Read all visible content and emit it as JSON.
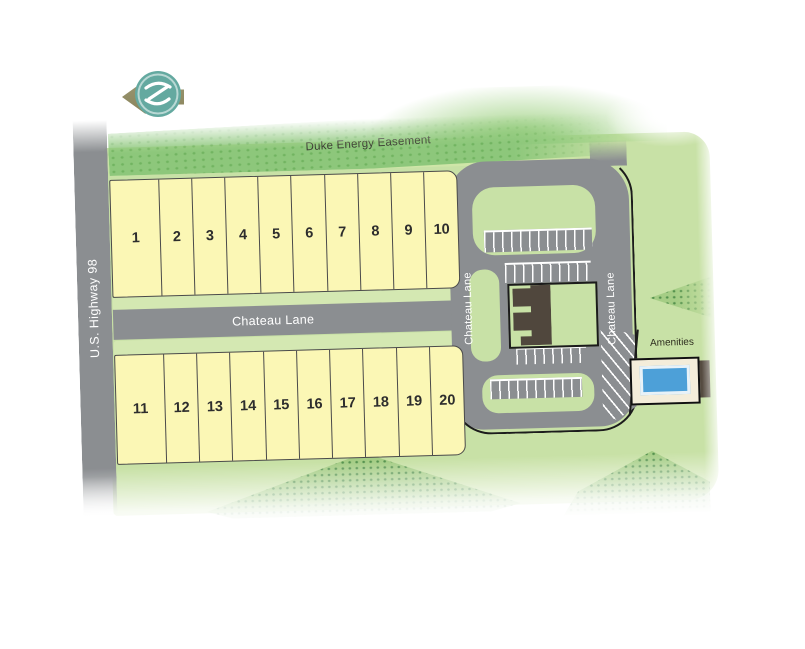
{
  "back_button": {
    "icon": "back-arrow-icon",
    "logo": "brand-globe-logo"
  },
  "labels": {
    "easement": "Duke Energy Easement",
    "highway": "U.S. Highway 98",
    "street": "Chateau Lane",
    "street_vertical_left": "Chateau Lane",
    "street_vertical_right": "Chateau Lane",
    "amenities": "Amenities"
  },
  "lots": {
    "row_top": [
      "1",
      "2",
      "3",
      "4",
      "5",
      "6",
      "7",
      "8",
      "9",
      "10"
    ],
    "row_bottom": [
      "11",
      "12",
      "13",
      "14",
      "15",
      "16",
      "17",
      "18",
      "19",
      "20"
    ]
  },
  "colors": {
    "lot_fill": "#FBF7B5",
    "lot_border": "#4A4A4A",
    "road_gray": "#8B8E91",
    "grass_green": "#C8E1A6",
    "verge_green": "#D4E8B2",
    "easement_green": "#8DC77B",
    "pool_blue": "#4DA0D8",
    "building_brown": "#50473D",
    "deck_cream": "#F4EDDA",
    "arrow_olive": "#8F8A60",
    "logo_teal": "#64A9A0"
  }
}
